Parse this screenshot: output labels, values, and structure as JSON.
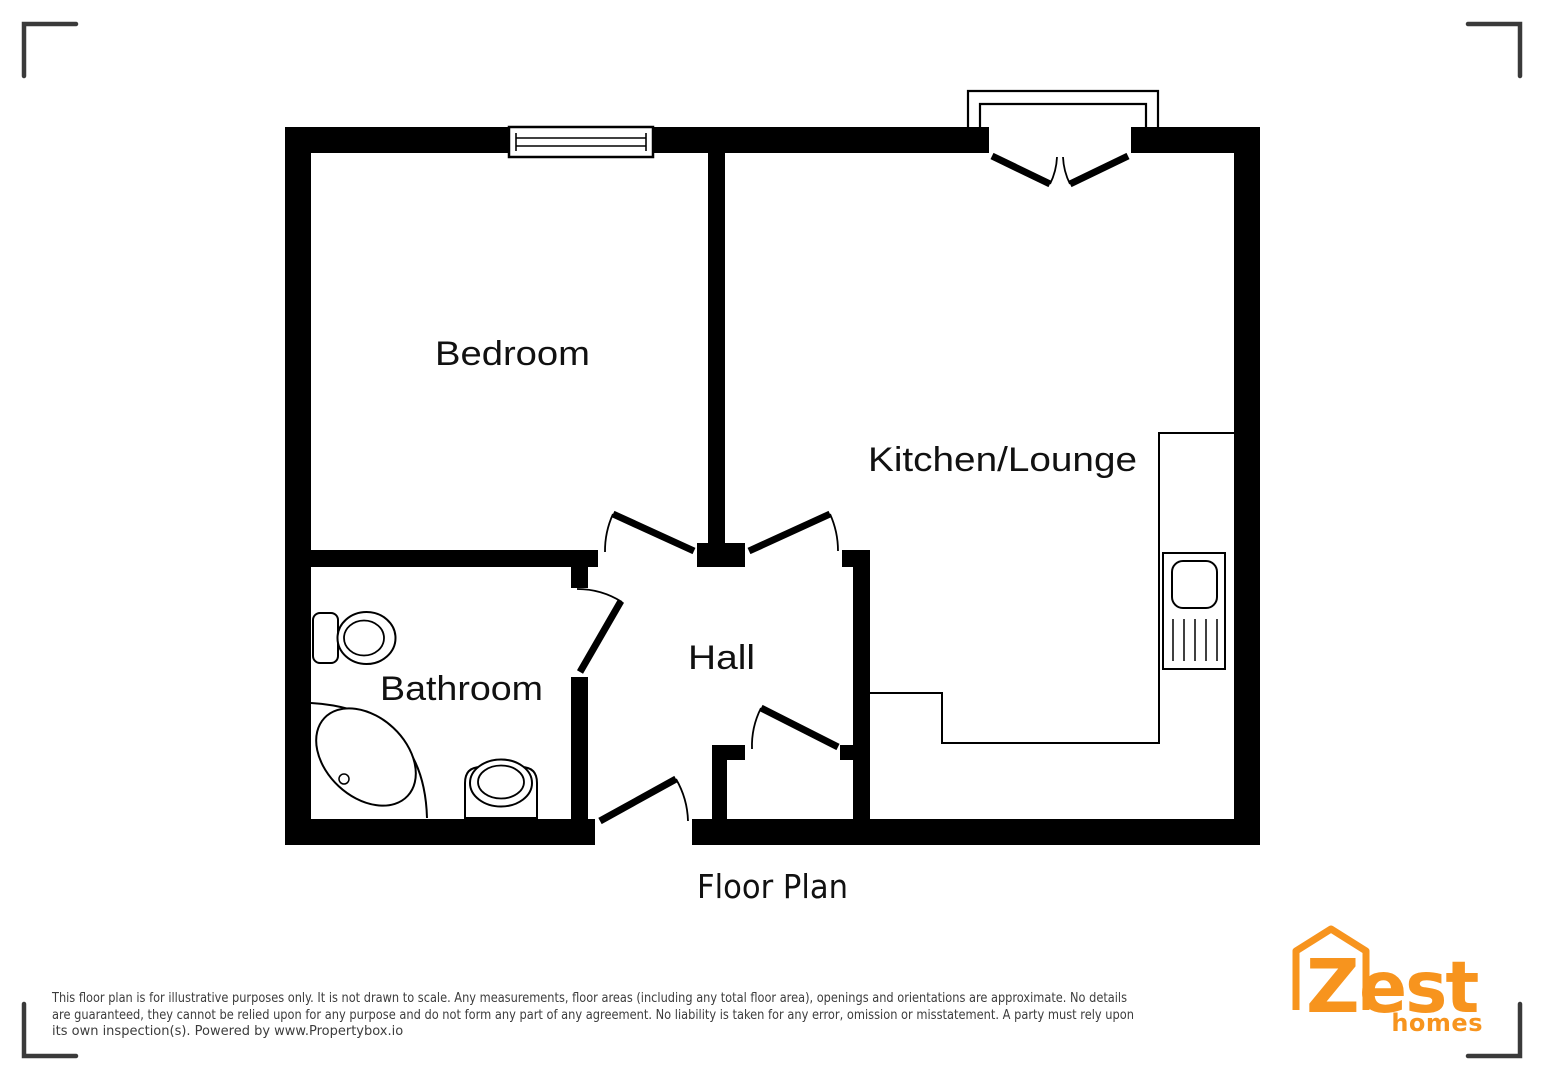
{
  "title": "Floor Plan",
  "rooms": {
    "bedroom": "Bedroom",
    "kitchen_lounge": "Kitchen/Lounge",
    "hall": "Hall",
    "bathroom": "Bathroom"
  },
  "disclaimer": {
    "line1": "This floor plan is for illustrative purposes only. It is not drawn to scale. Any measurements, floor areas (including any total floor area), openings and orientations are approximate. No details",
    "line2": "are guaranteed, they cannot be relied upon for any purpose and do not form any part of any agreement. No liability is taken for any error, omission or misstatement. A party must rely upon",
    "line3": "its own inspection(s). Powered by www.Propertybox.io"
  },
  "logo": {
    "letter": "Z",
    "est": "est",
    "homes": "homes"
  },
  "colors": {
    "wall": "#000000",
    "background": "#FFFFFF",
    "corner_marks": "#3A3A3A",
    "label_text": "#111111",
    "disclaimer_text": "#3C3C3C",
    "logo_orange": "#F7941E"
  }
}
